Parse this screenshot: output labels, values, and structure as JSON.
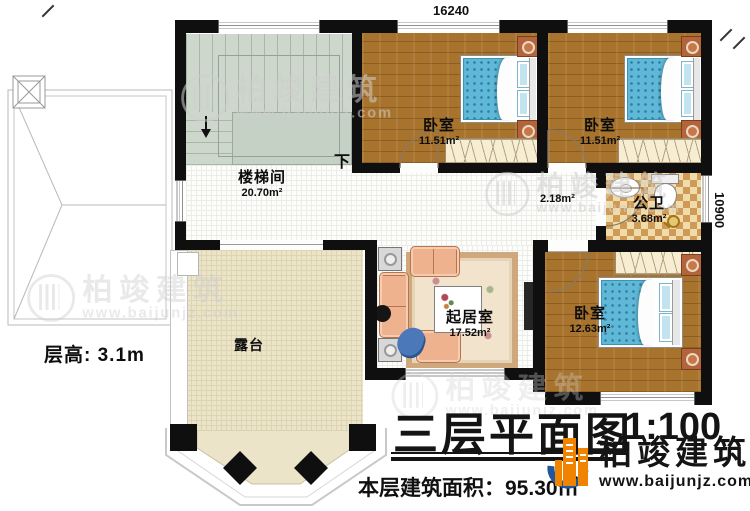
{
  "plan": {
    "dimensions": {
      "top": "16240",
      "right": "10900"
    },
    "floor_height": "层高: 3.1m",
    "stair_direction": "下",
    "rooms": {
      "stairwell": {
        "name": "楼梯间",
        "area": "20.70m²"
      },
      "bedroom1": {
        "name": "卧室",
        "area": "11.51m²"
      },
      "bedroom2": {
        "name": "卧室",
        "area": "11.51m²"
      },
      "corridor": {
        "area": "2.18m²"
      },
      "bathroom": {
        "name": "公卫",
        "area": "3.68m²"
      },
      "living": {
        "name": "起居室",
        "area": "17.52m²"
      },
      "bedroom3": {
        "name": "卧室",
        "area": "12.63m²"
      },
      "terrace": {
        "name": "露台"
      }
    }
  },
  "titleblock": {
    "title": "三层平面图",
    "scale": "1:100",
    "area_line": "本层建筑面积：95.30㎡"
  },
  "branding": {
    "name": "柏竣建筑",
    "url": "www.baijunjz.com",
    "suffix": "、"
  },
  "watermark": {
    "name": "柏竣建筑",
    "url": "www.baijunjz.com"
  },
  "colors": {
    "wall": "#0f0f0f",
    "wood_floor": "#a8732c",
    "stair_floor": "#cdd7cb",
    "terrace_floor": "#ebe4c8",
    "bath_tile_light": "#f0dcab",
    "bath_tile_dark": "#cf9a55",
    "bed_blue": "#5fb8d7",
    "logo_orange": "#f08300",
    "logo_blue": "#1e56a0"
  }
}
